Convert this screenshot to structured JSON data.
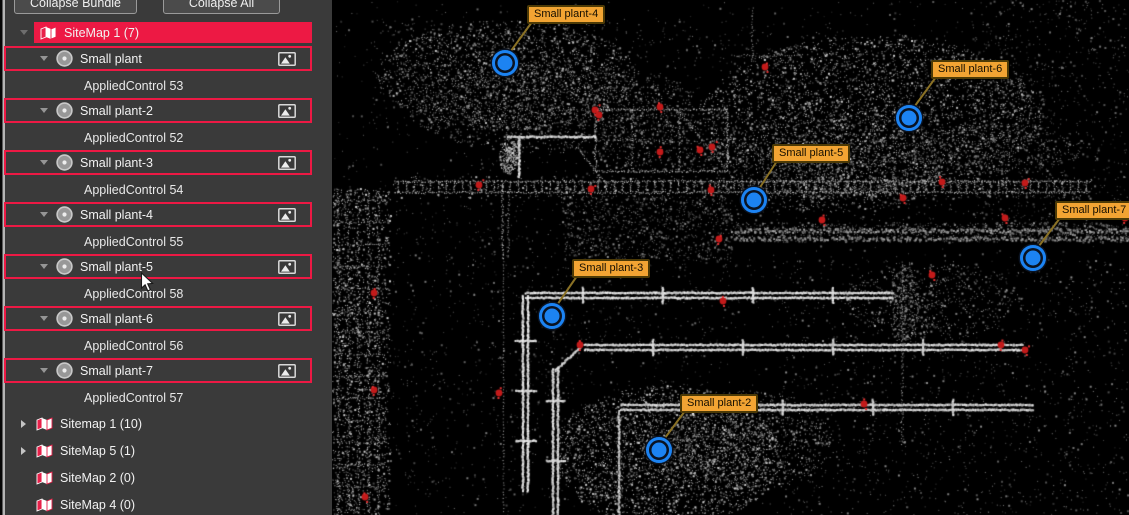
{
  "sidebar": {
    "buttons": [
      {
        "label": "Collapse Bundle"
      },
      {
        "label": "Collapse All"
      }
    ],
    "tree": [
      {
        "type": "bundle",
        "label": "SiteMap 1 (7)",
        "state": "expanded",
        "selected": true
      },
      {
        "type": "plant",
        "label": "Small plant"
      },
      {
        "type": "control",
        "label": "AppliedControl 53"
      },
      {
        "type": "plant",
        "label": "Small plant-2"
      },
      {
        "type": "control",
        "label": "AppliedControl 52"
      },
      {
        "type": "plant",
        "label": "Small plant-3"
      },
      {
        "type": "control",
        "label": "AppliedControl 54"
      },
      {
        "type": "plant",
        "label": "Small plant-4"
      },
      {
        "type": "control",
        "label": "AppliedControl 55"
      },
      {
        "type": "plant",
        "label": "Small plant-5"
      },
      {
        "type": "control",
        "label": "AppliedControl 58"
      },
      {
        "type": "plant",
        "label": "Small plant-6"
      },
      {
        "type": "control",
        "label": "AppliedControl 56"
      },
      {
        "type": "plant",
        "label": "Small plant-7"
      },
      {
        "type": "control",
        "label": "AppliedControl 57"
      },
      {
        "type": "bundle",
        "label": "Sitemap 1 (10)",
        "state": "collapsed",
        "selected": false
      },
      {
        "type": "bundle",
        "label": "SiteMap 5 (1)",
        "state": "collapsed",
        "selected": false
      },
      {
        "type": "bundle",
        "label": "SiteMap 2 (0)",
        "state": "none",
        "selected": false
      },
      {
        "type": "bundle",
        "label": "SiteMap 4 (0)",
        "state": "none",
        "selected": false
      }
    ]
  },
  "viewer": {
    "annotations": [
      {
        "name": "Small plant-4",
        "marker": {
          "x": 173,
          "y": 63
        },
        "label": {
          "x": 195,
          "y": 5
        }
      },
      {
        "name": "Small plant-6",
        "marker": {
          "x": 577,
          "y": 118
        },
        "label": {
          "x": 599,
          "y": 60
        }
      },
      {
        "name": "Small plant-5",
        "marker": {
          "x": 422,
          "y": 200
        },
        "label": {
          "x": 440,
          "y": 144
        }
      },
      {
        "name": "Small plant-7",
        "marker": {
          "x": 701,
          "y": 258
        },
        "label": {
          "x": 723,
          "y": 201
        }
      },
      {
        "name": "Small plant-3",
        "marker": {
          "x": 220,
          "y": 316
        },
        "label": {
          "x": 240,
          "y": 259
        }
      },
      {
        "name": "Small plant-2",
        "marker": {
          "x": 327,
          "y": 450
        },
        "label": {
          "x": 348,
          "y": 394
        }
      }
    ],
    "red_points": [
      [
        433,
        67
      ],
      [
        263,
        110
      ],
      [
        328,
        107
      ],
      [
        267,
        115
      ],
      [
        328,
        152
      ],
      [
        368,
        150
      ],
      [
        380,
        147
      ],
      [
        147,
        185
      ],
      [
        259,
        189
      ],
      [
        379,
        190
      ],
      [
        610,
        182
      ],
      [
        693,
        183
      ],
      [
        571,
        198
      ],
      [
        490,
        220
      ],
      [
        673,
        218
      ],
      [
        793,
        218
      ],
      [
        387,
        239
      ],
      [
        600,
        275
      ],
      [
        42,
        293
      ],
      [
        391,
        301
      ],
      [
        248,
        345
      ],
      [
        669,
        345
      ],
      [
        693,
        350
      ],
      [
        42,
        390
      ],
      [
        167,
        393
      ],
      [
        532,
        404
      ],
      [
        33,
        497
      ]
    ],
    "colors": {
      "marker_fill": "#1c83f2",
      "marker_ring": "#0a1322",
      "label_bg": "#f2a433",
      "label_border": "#4c3a06",
      "label_text": "#140e00",
      "leader_line": "#8a7125",
      "red_point": "#c31a1a",
      "selection": "#ed1944"
    }
  }
}
